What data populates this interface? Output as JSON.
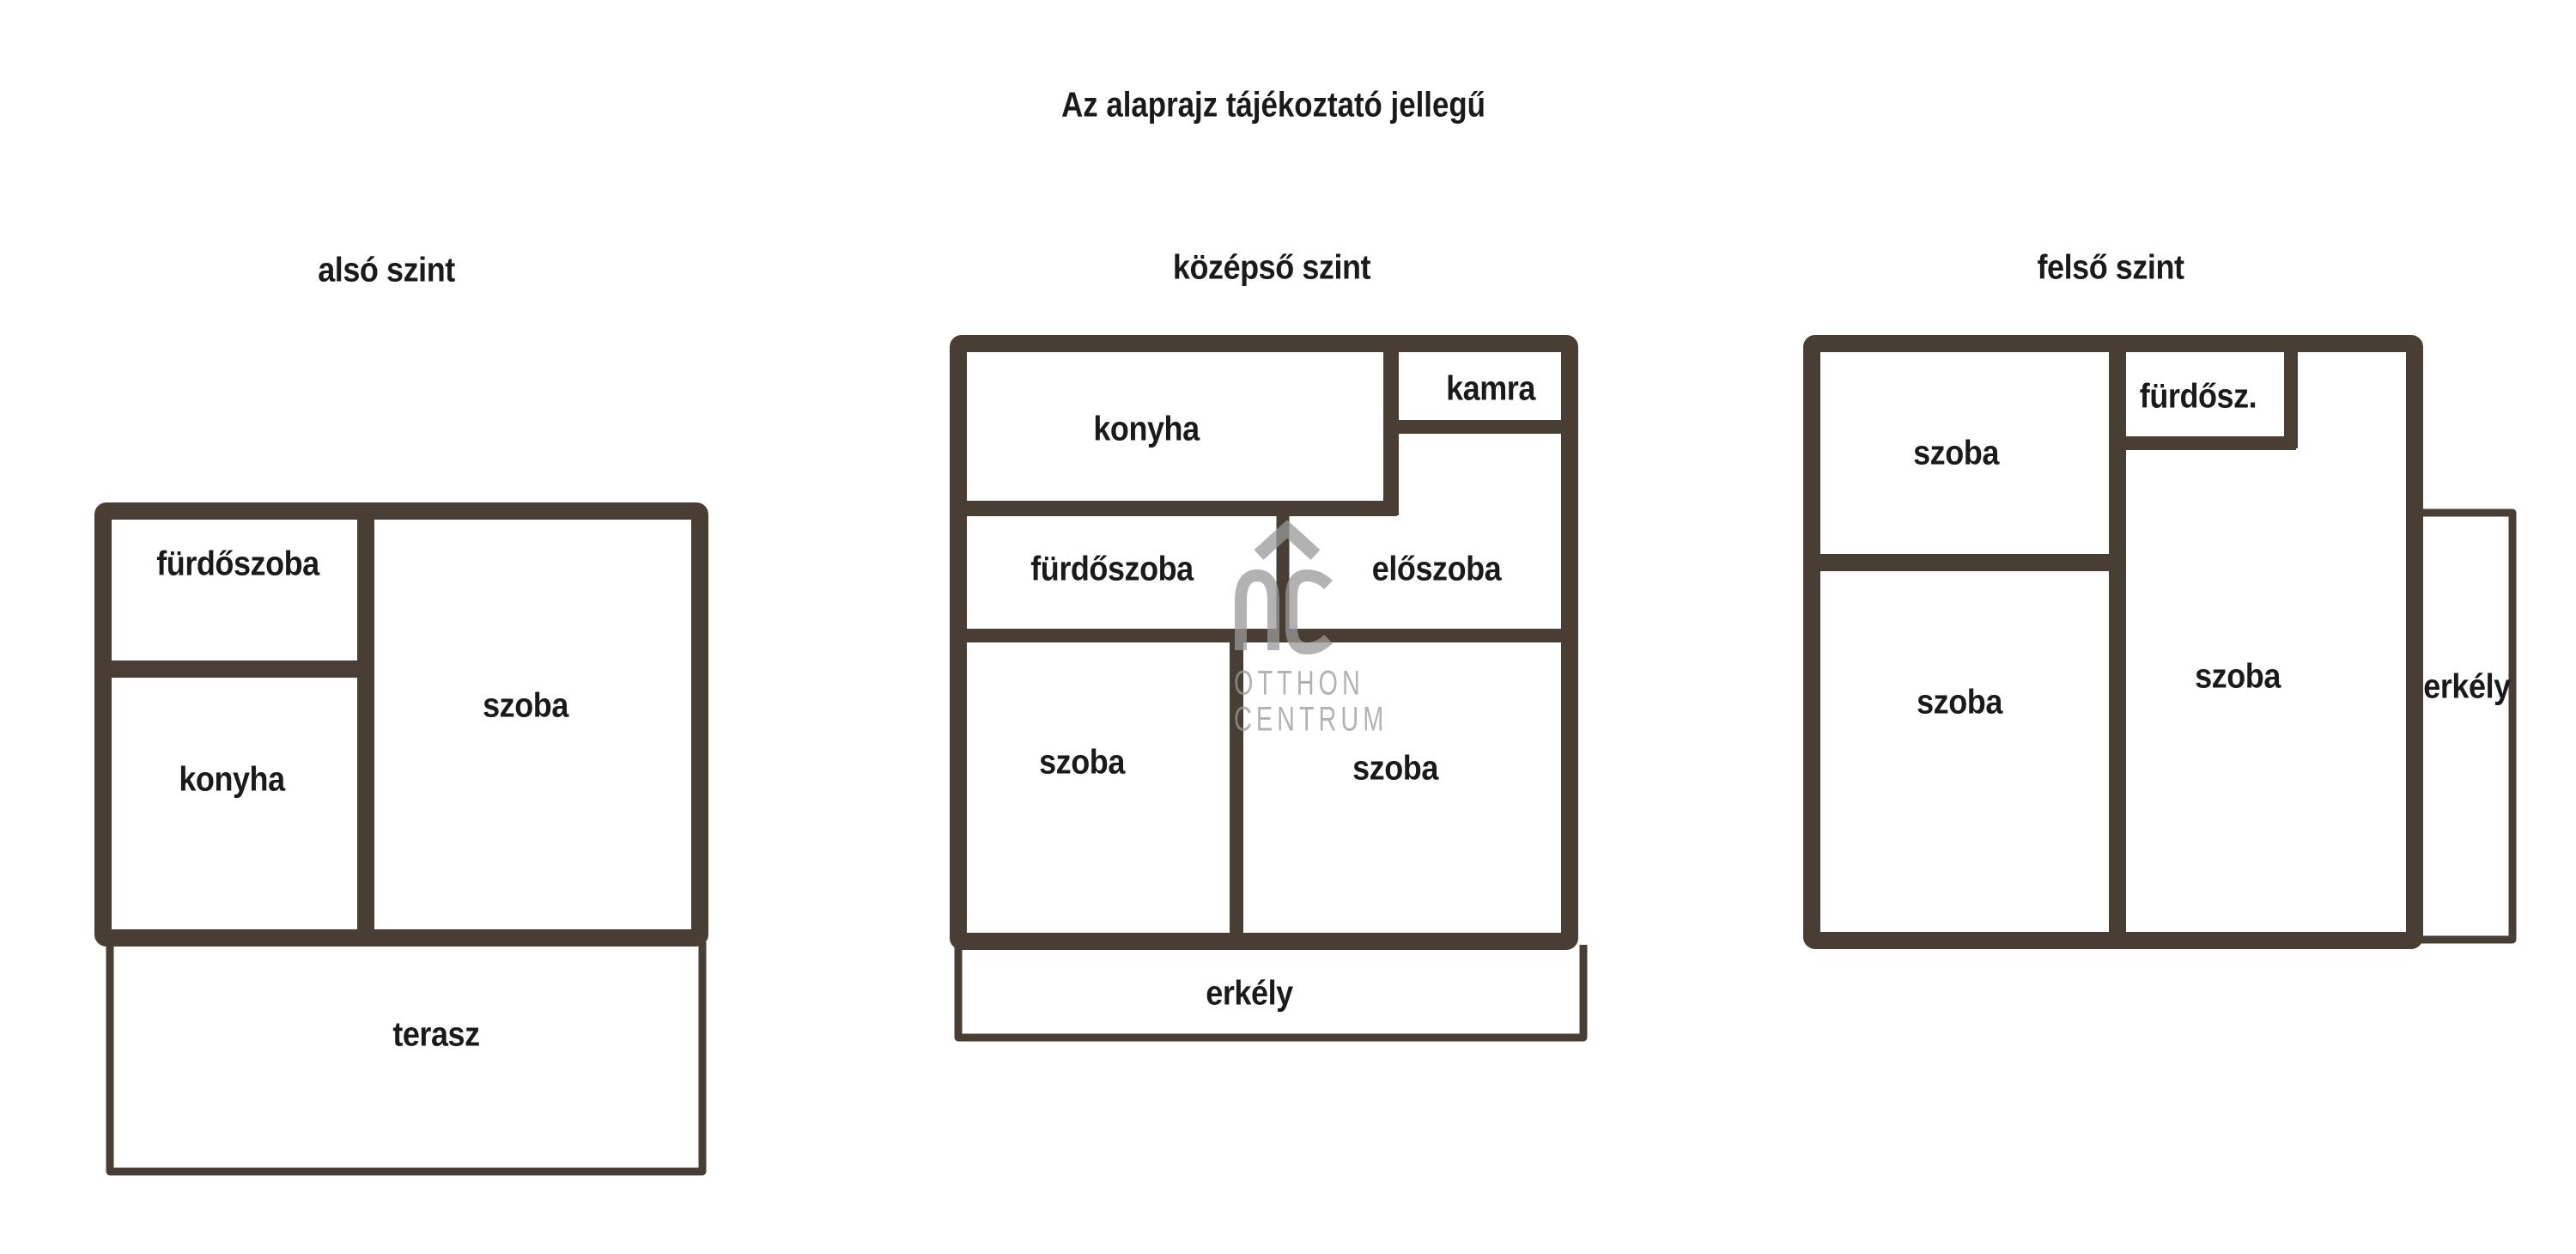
{
  "title": "Az alaprajz tájékoztató jellegű",
  "colors": {
    "wall": "#483e34",
    "label_text": "#1a1a1a",
    "watermark": "#999999",
    "background": "#ffffff"
  },
  "floors": [
    {
      "label": "alsó szint",
      "rooms": [
        {
          "name": "fürdőszoba"
        },
        {
          "name": "konyha"
        },
        {
          "name": "szoba"
        },
        {
          "name": "terasz"
        }
      ]
    },
    {
      "label": "középső szint",
      "rooms": [
        {
          "name": "konyha"
        },
        {
          "name": "kamra"
        },
        {
          "name": "fürdőszoba"
        },
        {
          "name": "előszoba"
        },
        {
          "name": "szoba"
        },
        {
          "name": "szoba"
        },
        {
          "name": "erkély"
        }
      ]
    },
    {
      "label": "felső szint",
      "rooms": [
        {
          "name": "szoba"
        },
        {
          "name": "fürdősz."
        },
        {
          "name": "szoba"
        },
        {
          "name": "szoba"
        },
        {
          "name": "erkély"
        }
      ]
    }
  ],
  "watermark": {
    "monogram": "OC",
    "brand_line1": "OTTHON",
    "brand_line2": "CENTRUM"
  }
}
